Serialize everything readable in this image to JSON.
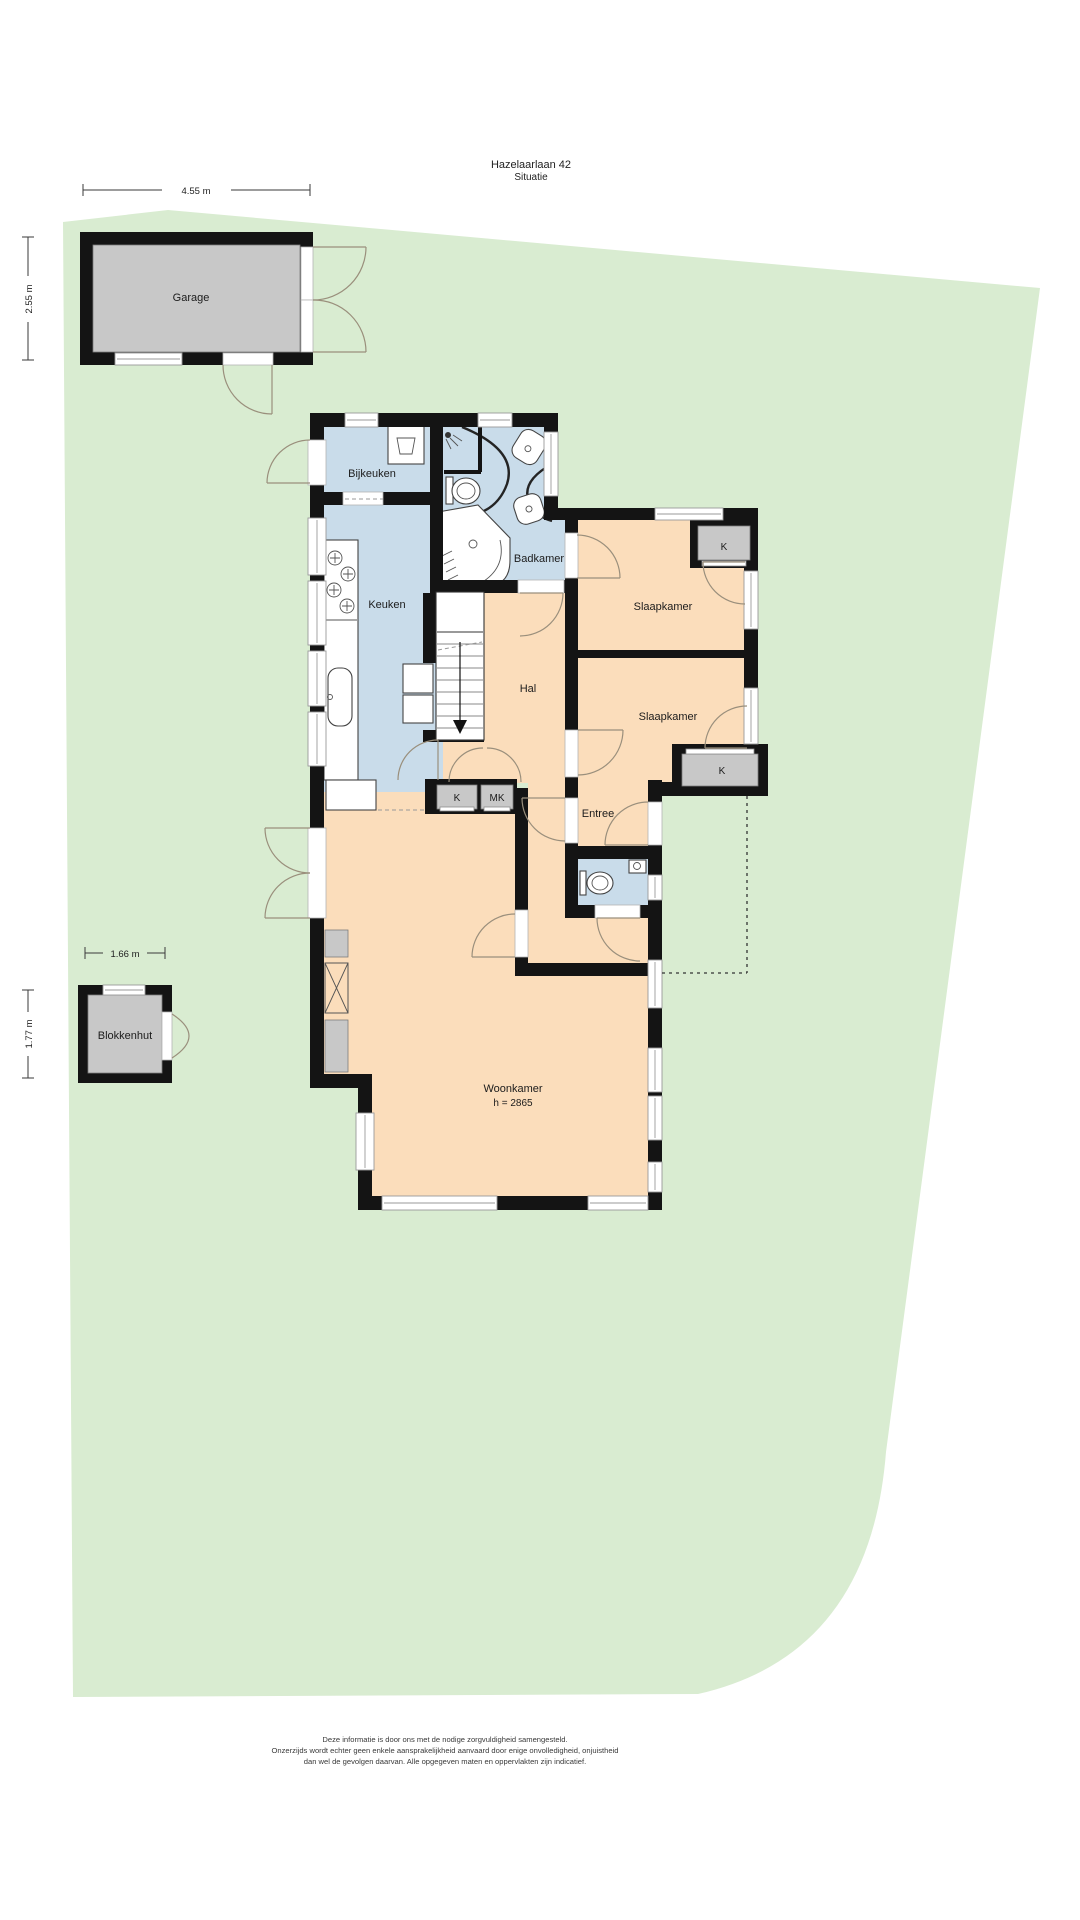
{
  "title": {
    "address": "Hazelaarlaan 42",
    "subtitle": "Situatie"
  },
  "garage": {
    "label": "Garage",
    "width": "4.55 m",
    "depth": "2.55 m"
  },
  "blokkenhut": {
    "label": "Blokkenhut",
    "width": "1.66 m",
    "depth": "1.77 m"
  },
  "rooms": {
    "bijkeuken": "Bijkeuken",
    "badkamer": "Badkamer",
    "keuken": "Keuken",
    "hal": "Hal",
    "slaapkamer_boven": "Slaapkamer",
    "slaapkamer_onder": "Slaapkamer",
    "entree": "Entree",
    "woonkamer": "Woonkamer",
    "woonkamer_hoogte": "h = 2865",
    "kast_slaapkamer_boven": "K",
    "kast_slaapkamer_onder": "K",
    "kast_hal": "K",
    "meterkast": "MK"
  },
  "disclaimer": {
    "line1": "Deze informatie is door ons met de nodige zorgvuldigheid samengesteld.",
    "line2": "Onzerzijds wordt echter geen enkele aansprakelijkheid aanvaard door enige onvolledigheid, onjuistheid",
    "line3": "dan wel de gevolgen daarvan. Alle opgegeven maten en oppervlakten zijn indicatief."
  },
  "colors": {
    "plot": "#d9ecd1",
    "blue_room": "#c9dcea",
    "orange_room": "#fbddbb",
    "gray_building": "#c8c8c8",
    "wall": "#141414"
  }
}
